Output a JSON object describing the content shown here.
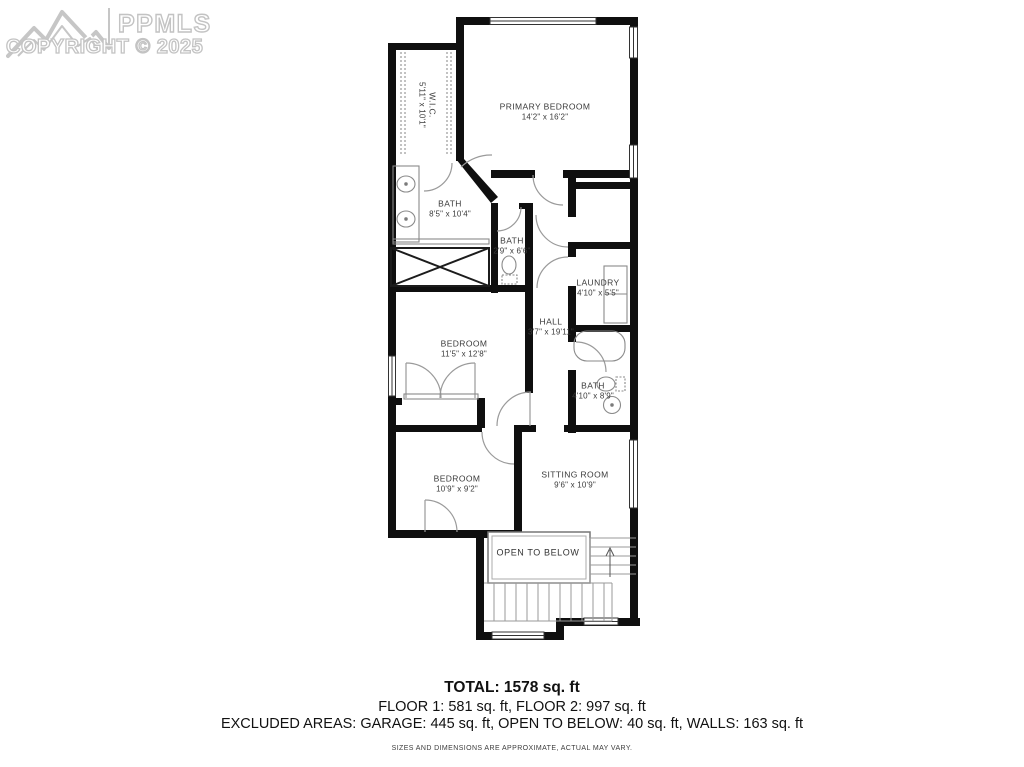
{
  "logo": {
    "brand": "PPMLS",
    "copyright": "COPYRIGHT © 2025"
  },
  "rooms": {
    "primary_bedroom": {
      "name": "PRIMARY BEDROOM",
      "dims": "14'2\" x 16'2\""
    },
    "wic": {
      "name": "W.I.C.",
      "dims": "5'11\" x 10'1\""
    },
    "bath_primary": {
      "name": "BATH",
      "dims": "8'5\" x 10'4\""
    },
    "bath_small": {
      "name": "BATH",
      "dims": "2'9\" x 6'6\""
    },
    "laundry": {
      "name": "LAUNDRY",
      "dims": "4'10\" x 5'5\""
    },
    "hall": {
      "name": "HALL",
      "dims": "3'7\" x 19'11\""
    },
    "bedroom_mid": {
      "name": "BEDROOM",
      "dims": "11'5\" x 12'8\""
    },
    "bath_hall": {
      "name": "BATH",
      "dims": "4'10\" x 8'9\""
    },
    "bedroom_lower": {
      "name": "BEDROOM",
      "dims": "10'9\" x 9'2\""
    },
    "sitting_room": {
      "name": "SITTING ROOM",
      "dims": "9'6\" x 10'9\""
    },
    "open_to_below": {
      "name": "OPEN TO BELOW"
    }
  },
  "summary": {
    "total": "TOTAL: 1578 sq. ft",
    "floors": "FLOOR 1: 581 sq. ft, FLOOR 2: 997 sq. ft",
    "excluded": "EXCLUDED AREAS: GARAGE: 445 sq. ft, OPEN TO BELOW: 40 sq. ft, WALLS: 163 sq. ft",
    "disclaimer": "SIZES AND DIMENSIONS ARE APPROXIMATE, ACTUAL MAY VARY."
  }
}
